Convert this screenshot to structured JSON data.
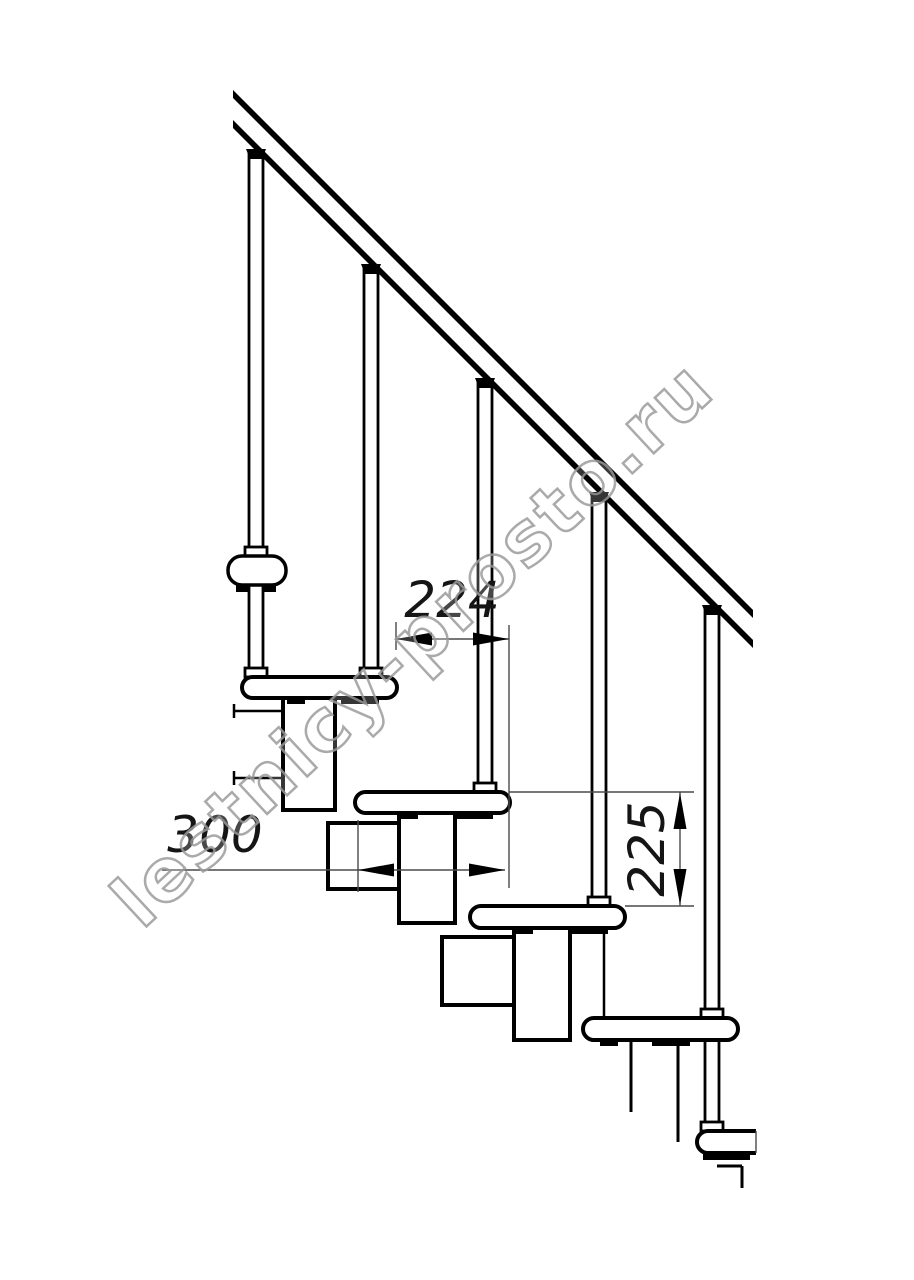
{
  "title": "Modular staircase side-view technical drawing",
  "watermark": {
    "text": "lestnicy-prosto.ru"
  },
  "dimensions": {
    "going": {
      "value": "224",
      "orientation": "horizontal"
    },
    "module": {
      "value": "300",
      "orientation": "horizontal"
    },
    "rise": {
      "value": "225",
      "orientation": "vertical"
    }
  },
  "colors": {
    "line": "#000000",
    "dimension_line": "#4a4a4a",
    "watermark": "#9c9c9c",
    "background": "#ffffff"
  }
}
